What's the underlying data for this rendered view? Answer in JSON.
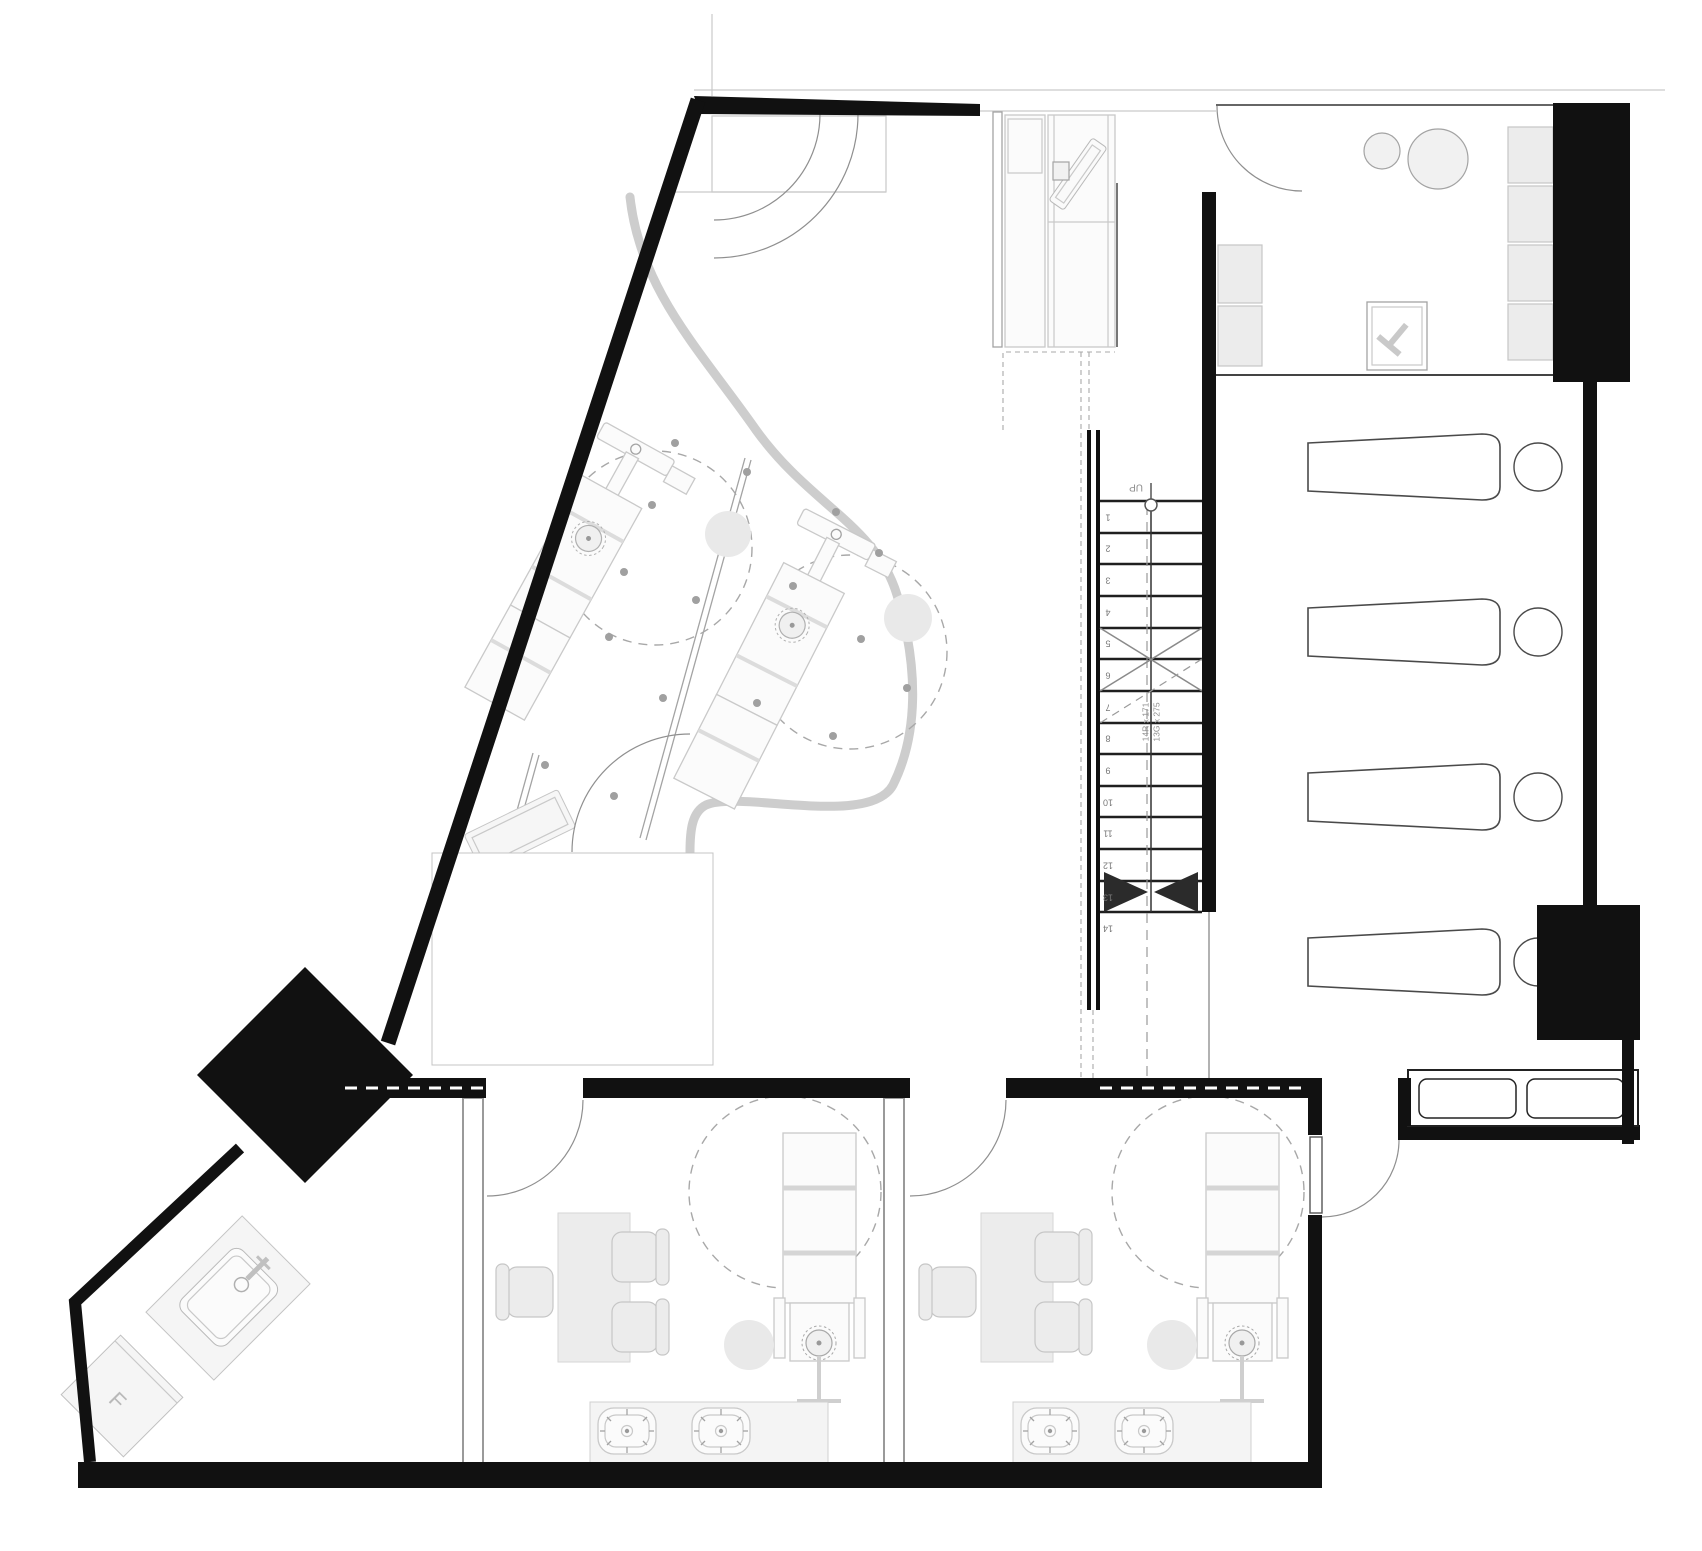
{
  "stair": {
    "up_label": "UP",
    "risers_annotation": "14R x 171",
    "goings_annotation": "13G x 275",
    "step_numbers": [
      "1",
      "2",
      "3",
      "4",
      "5",
      "6",
      "7",
      "8",
      "9",
      "10",
      "11",
      "12",
      "13",
      "14"
    ]
  },
  "labels": {
    "fridge": "F"
  },
  "colors": {
    "wall": "#111111",
    "line_light": "#c9c9c9",
    "line_mid": "#a3a3a3",
    "line_dark": "#555555",
    "fill_light": "#f1f1f1",
    "fill_soft": "#ececec",
    "fill_pale": "#fbfbfb",
    "stair_line": "#1f1f1f",
    "text_gray": "#8c8c8c",
    "dash_gray": "#a8a8a8",
    "curve_gray": "#cdcdcd"
  },
  "inventory": {
    "stair_risers": 14,
    "open_studio_treatment_stations": 2,
    "lounge_loungers": 4,
    "lounge_stools": 4,
    "entry_sofa_seats": 2,
    "consult_rooms": 2,
    "consult_room_desk_chairs": 3,
    "consult_room_sinks": 2,
    "top_right_room_cabinets": 4,
    "top_right_room_round_tables": 2
  }
}
